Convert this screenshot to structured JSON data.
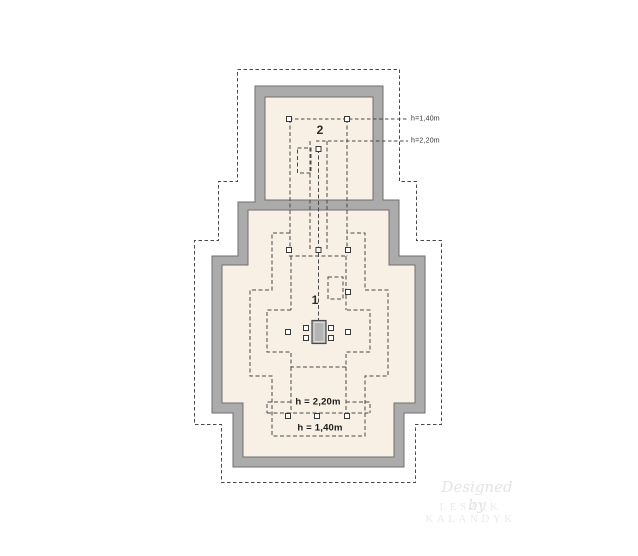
{
  "plan": {
    "room1_label": "1",
    "room2_label": "2",
    "leader_labels": {
      "h140": "h=1,40m",
      "h220": "h=2,20m"
    },
    "dim_labels": {
      "h220": "h = 2,20m",
      "h140": "h = 1,40m"
    }
  },
  "watermark": {
    "line1": "Designed by",
    "line2": "LESZEK KALANDYK"
  },
  "colors": {
    "interior": "#f8efe5",
    "wall": "#ababab",
    "wall_border": "#6f6f6f",
    "dash": "#4a4a4a",
    "chimney_fill": "#b4b4b4",
    "chimney_border": "#4a4a4a",
    "marker_fill": "#ffffff",
    "marker_border": "#3a3a3a"
  }
}
